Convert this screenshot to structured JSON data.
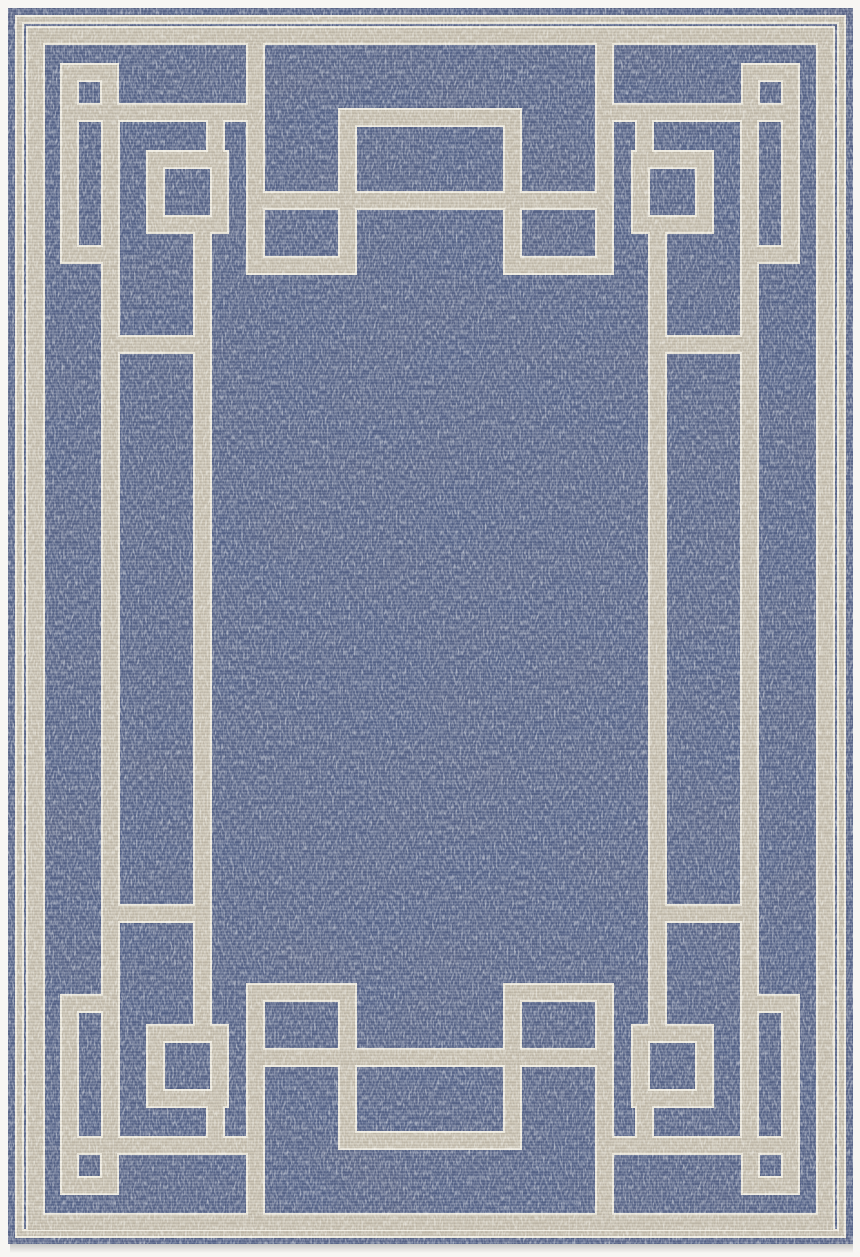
{
  "page": {
    "background_color": "#f7f6f3",
    "alt_text": "Overhead product photograph of a rectangular flat-weave area rug on a white background: heathered denim-blue field bordered by a taupe-and-cream Greek-key style pattern of interlocking lines and squares"
  },
  "rug": {
    "field_color": "#56648a",
    "field_highlight": "#aeb6c8",
    "band_color": "#c7bfaf",
    "band_edge_color": "#ede9dc",
    "shadow_color": "#b9b7b2",
    "pattern_style": "greek-key interlocking squares border",
    "motifs": [
      "outer pinstripe frame",
      "outer border band",
      "corner square motif top-left",
      "corner square motif top-right",
      "corner square motif bottom-left",
      "corner square motif bottom-right",
      "medium square motif top-left",
      "medium square motif top-right",
      "medium square motif bottom-left",
      "medium square motif bottom-right",
      "center gate motif top",
      "center gate motif bottom",
      "interlocking meander bands"
    ]
  }
}
